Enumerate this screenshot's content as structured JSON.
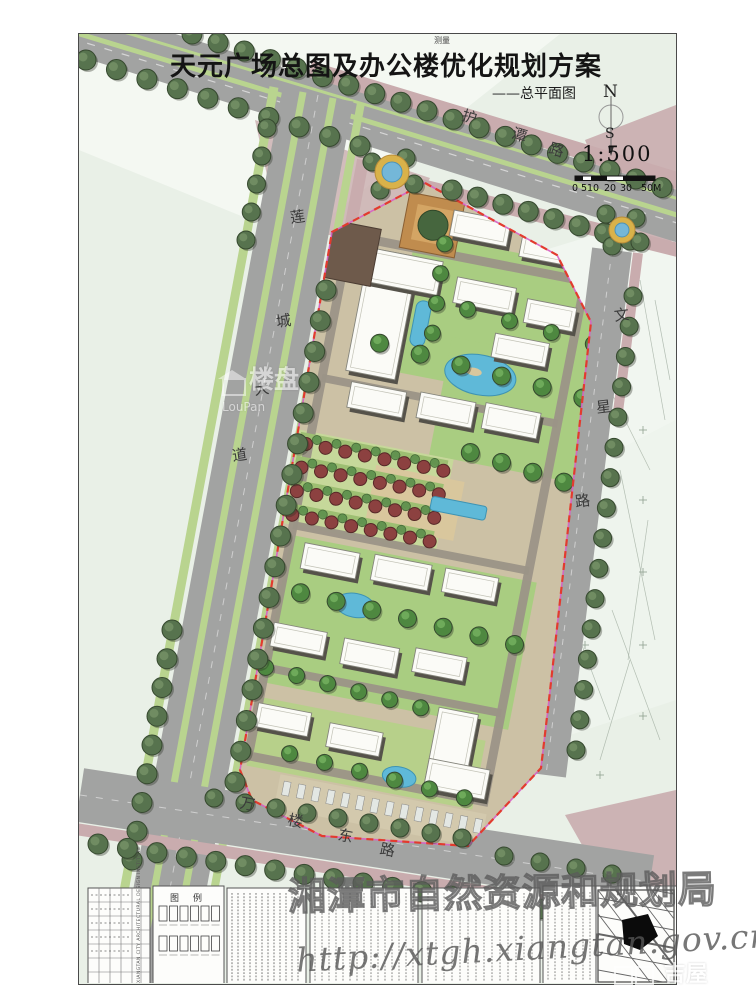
{
  "drawing": {
    "title": "天元广场总图及办公楼优化规划方案",
    "subtitle": "——总平面图",
    "survey_label": "测量",
    "compass": {
      "north": "N",
      "south": "S"
    },
    "scale": {
      "ratio": "1:500",
      "ticks": [
        "0",
        "5",
        "10",
        "20",
        "30",
        "50M"
      ]
    },
    "roads": {
      "hutan": {
        "name": "护潭路",
        "chars": [
          "护",
          "潭",
          "路"
        ]
      },
      "liancheng": {
        "name": "莲城大道",
        "chars": [
          "莲",
          "城",
          "大",
          "道"
        ]
      },
      "wenxing": {
        "name": "文星路",
        "chars": [
          "文",
          "星",
          "路"
        ]
      },
      "wanlou": {
        "name": "万楼东路",
        "chars": [
          "万",
          "楼",
          "东",
          "路"
        ]
      }
    },
    "titleblock": {
      "legend_title": "图例",
      "institute_en": "XIANGTAN CITY ARCHITECTURAL DESIGN INSTITUTE"
    },
    "watermarks": {
      "loupan_cn": "楼盘",
      "loupan_en": "LouPan",
      "bureau": "湘潭市自然资源和规划局",
      "url": "http://xtgh.xiangtan.gov.cn/",
      "jiwu": "吉屋"
    },
    "colors": {
      "boundary_red": "#e23b2e",
      "boundary_magenta": "#d85fc4",
      "water_blue": "#5fb9d8",
      "road_gray": "#a2a3a2",
      "tree_green": "#57734e",
      "sidewalk_mauve": "#c9acae"
    }
  }
}
